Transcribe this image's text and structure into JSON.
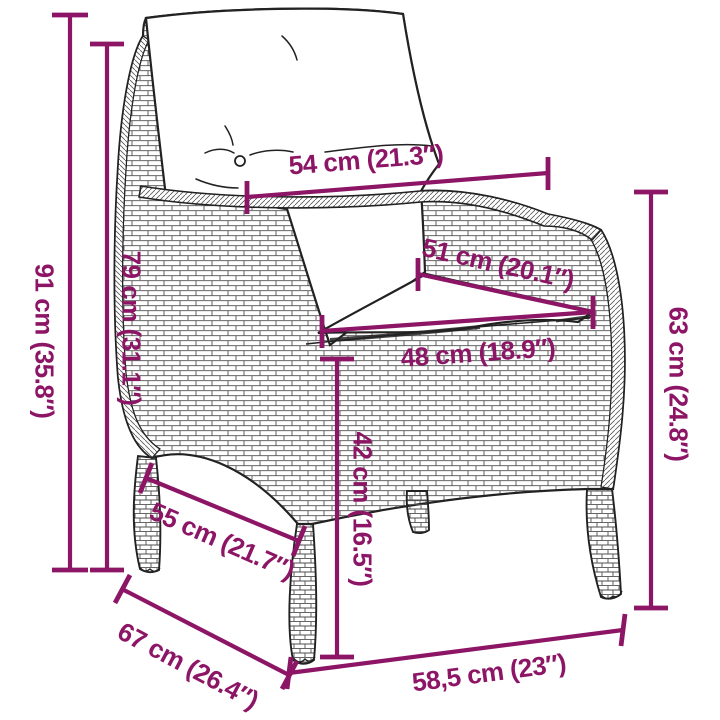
{
  "page": {
    "type": "product-dimension-diagram",
    "subject": "poly-rattan garden armchair with back and seat cushions",
    "background": "#ffffff"
  },
  "colors": {
    "dimension_accent": "#8D1566",
    "line_art": "#222222"
  },
  "dimensions": [
    {
      "id": "total-height",
      "label": "91 cm (35.8″)"
    },
    {
      "id": "back-height",
      "label": "79 cm (31.1″)"
    },
    {
      "id": "back-cushion-width",
      "label": "54 cm (21.3″)"
    },
    {
      "id": "seat-cushion-depth",
      "label": "51 cm (20.1″)"
    },
    {
      "id": "seat-front-width",
      "label": "48 cm (18.9″)"
    },
    {
      "id": "armrest-height",
      "label": "63 cm (24.8″)"
    },
    {
      "id": "seat-height",
      "label": "42 cm (16.5″)"
    },
    {
      "id": "seat-depth",
      "label": "55 cm (21.7″)"
    },
    {
      "id": "total-depth",
      "label": "67 cm (26.4″)"
    },
    {
      "id": "front-width",
      "label": "58,5 cm (23″)"
    }
  ]
}
